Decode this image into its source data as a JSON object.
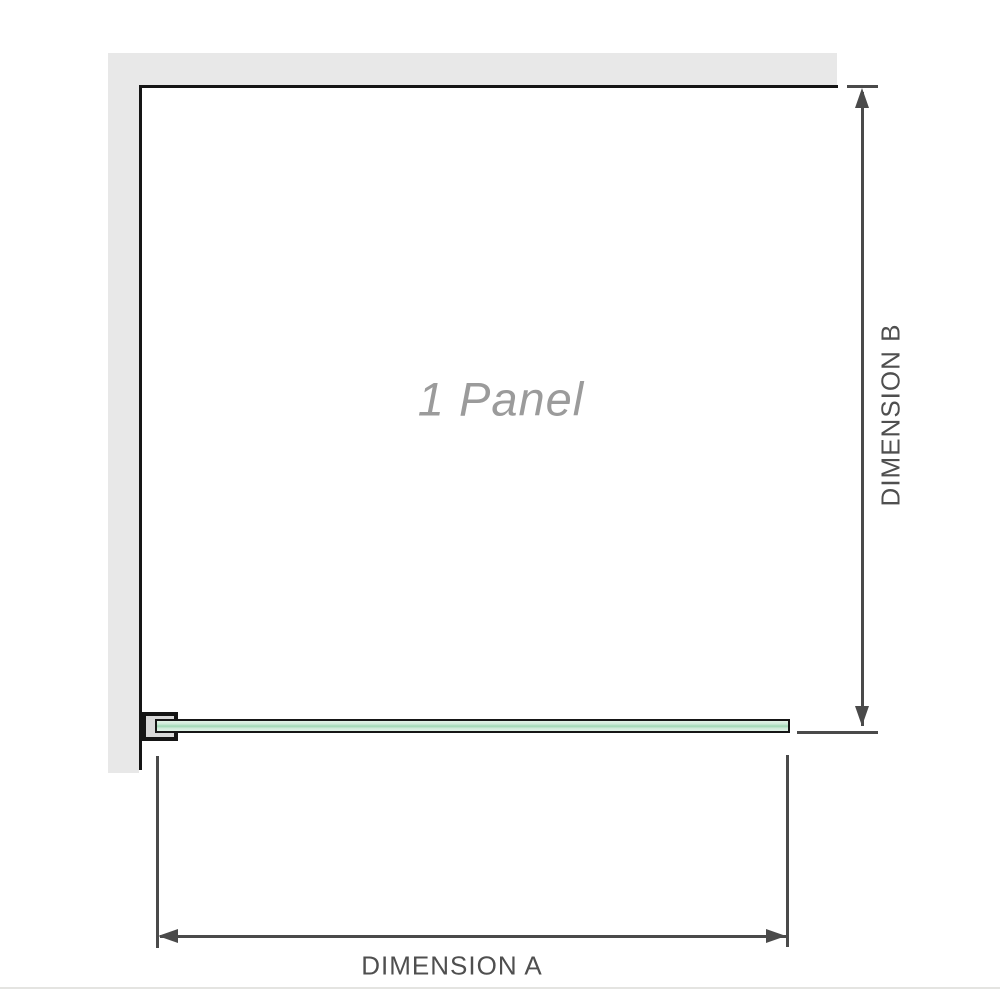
{
  "diagram": {
    "panel_label": "1 Panel",
    "dimensions": {
      "a": {
        "label": "DIMENSION A",
        "orientation": "horizontal"
      },
      "b": {
        "label": "DIMENSION B",
        "orientation": "vertical"
      }
    },
    "icons": [
      "arrow-up-icon",
      "arrow-down-icon",
      "arrow-left-icon",
      "arrow-right-icon"
    ],
    "colors": {
      "wall": "#e8e8e8",
      "edge": "#151515",
      "dimension_line": "#4a4a4a",
      "dimension_text": "#4f4f4f",
      "panel_label_text": "#9b9b9b",
      "glass_border": "#161616",
      "glass_fill_light": "#e2f3e8",
      "glass_fill_mid": "#cdebd8",
      "glass_fill_dark": "#9fd8b4",
      "bracket_fill": "#d9d9d9",
      "baseline": "#e4e4e1"
    }
  }
}
